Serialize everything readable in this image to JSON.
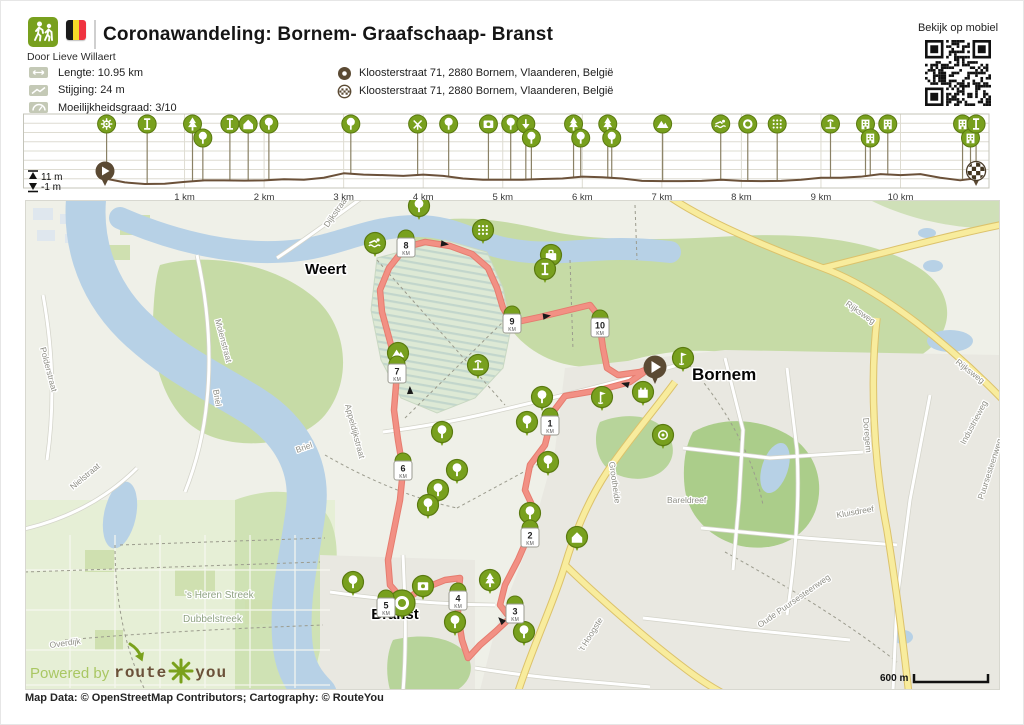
{
  "colors": {
    "marker": "#78a01e",
    "marker_border": "#5a7a10",
    "brown": "#5b4a33",
    "route": "#f29084",
    "route_edge": "#e57c6f",
    "water": "#b7d1e6",
    "grid": "#dedcd2",
    "frame": "#c4c4ba"
  },
  "header": {
    "title": "Coronawandeling: Bornem- Graafschaap- Branst",
    "author": "Door Lieve Willaert"
  },
  "qr": {
    "label": "Bekijk op mobiel"
  },
  "stats": {
    "items": [
      {
        "icon": "distance-icon",
        "text": "Lengte: 10.95 km"
      },
      {
        "icon": "ascent-icon",
        "text": "Stijging: 24 m"
      },
      {
        "icon": "difficulty-icon",
        "text": "Moeilijkheidsgraad: 3/10"
      }
    ]
  },
  "addresses": {
    "items": [
      {
        "icon": "start-marker-icon",
        "text": "Kloosterstraat 71, 2880 Bornem, Vlaanderen, België"
      },
      {
        "icon": "finish-marker-icon",
        "text": "Kloosterstraat 71, 2880 Bornem, Vlaanderen, België"
      }
    ]
  },
  "chart_data": {
    "type": "line",
    "title": "Elevation profile",
    "xlabel": "distance",
    "ylabel": "elevation",
    "x_unit": "km",
    "xlim": [
      0,
      10.95
    ],
    "ylim": [
      -1,
      11
    ],
    "max_label": "11 m",
    "min_label": "-1 m",
    "x_ticks": [
      "1 km",
      "2 km",
      "3 km",
      "4 km",
      "5 km",
      "6 km",
      "7 km",
      "8 km",
      "9 km",
      "10 km"
    ],
    "x_km": [
      0,
      0.25,
      0.5,
      0.75,
      1,
      1.25,
      1.5,
      1.75,
      2,
      2.25,
      2.5,
      2.75,
      3,
      3.25,
      3.5,
      3.75,
      4,
      4.25,
      4.5,
      4.75,
      5,
      5.25,
      5.5,
      5.75,
      6,
      6.25,
      6.5,
      6.75,
      7,
      7.25,
      7.5,
      7.75,
      8,
      8.25,
      8.5,
      8.75,
      9,
      9.25,
      9.5,
      9.75,
      10,
      10.25,
      10.5,
      10.75,
      10.95
    ],
    "elevation_m": [
      2.5,
      1,
      0.4,
      0.5,
      1.2,
      1.8,
      1.8,
      1.7,
      1.8,
      2.2,
      2,
      2.8,
      4.5,
      4,
      3.8,
      3.5,
      4,
      3.5,
      2.5,
      2,
      2,
      2,
      2.3,
      2.5,
      3.2,
      3,
      2.5,
      1.6,
      1.5,
      1.5,
      1.6,
      2,
      1.6,
      1.5,
      1.6,
      2,
      2.8,
      2.8,
      3.2,
      4.2,
      3.8,
      4.2,
      2.8,
      1.8,
      2.6
    ],
    "markers": [
      {
        "km": 0.02,
        "icon": "gear",
        "row": 0
      },
      {
        "km": 0.53,
        "icon": "tower",
        "row": 0
      },
      {
        "km": 1.1,
        "icon": "conifer",
        "row": 0
      },
      {
        "km": 1.23,
        "icon": "tree",
        "row": 1
      },
      {
        "km": 1.57,
        "icon": "tower",
        "row": 0
      },
      {
        "km": 1.8,
        "icon": "house",
        "row": 0
      },
      {
        "km": 2.06,
        "icon": "tree",
        "row": 0
      },
      {
        "km": 3.09,
        "icon": "tree",
        "row": 0
      },
      {
        "km": 3.93,
        "icon": "windmill",
        "row": 0
      },
      {
        "km": 4.32,
        "icon": "tree",
        "row": 0
      },
      {
        "km": 4.82,
        "icon": "photo",
        "row": 0
      },
      {
        "km": 5.1,
        "icon": "tree",
        "row": 0
      },
      {
        "km": 5.29,
        "icon": "arrowdown",
        "row": 0
      },
      {
        "km": 5.36,
        "icon": "tree",
        "row": 1
      },
      {
        "km": 5.89,
        "icon": "conifer",
        "row": 0
      },
      {
        "km": 5.98,
        "icon": "tree",
        "row": 1
      },
      {
        "km": 6.32,
        "icon": "conifer",
        "row": 0
      },
      {
        "km": 6.37,
        "icon": "tree",
        "row": 1
      },
      {
        "km": 7.01,
        "icon": "mountain",
        "row": 0
      },
      {
        "km": 7.74,
        "icon": "swim",
        "row": 0
      },
      {
        "km": 8.08,
        "icon": "ring",
        "row": 0
      },
      {
        "km": 8.45,
        "icon": "grid",
        "row": 0
      },
      {
        "km": 9.12,
        "icon": "fountain",
        "row": 0
      },
      {
        "km": 9.56,
        "icon": "building",
        "row": 0
      },
      {
        "km": 9.62,
        "icon": "building",
        "row": 1
      },
      {
        "km": 9.84,
        "icon": "building",
        "row": 0
      },
      {
        "km": 10.78,
        "icon": "building",
        "row": 0
      },
      {
        "km": 10.88,
        "icon": "building",
        "row": 1
      },
      {
        "km": 10.95,
        "icon": "tower",
        "row": 0
      }
    ]
  },
  "map": {
    "city_labels": [
      {
        "text": "Weert",
        "x": 280,
        "y": 74,
        "size": 15,
        "anchor": "start"
      },
      {
        "text": "Bornem",
        "x": 667,
        "y": 180,
        "size": 17,
        "anchor": "start"
      },
      {
        "text": "Branst",
        "x": 370,
        "y": 419,
        "size": 15,
        "anchor": "middle"
      }
    ],
    "street_labels": [
      {
        "text": "Dijkstraat",
        "x": 303,
        "y": 28,
        "rot": -55
      },
      {
        "text": "Molenstraat",
        "x": 190,
        "y": 120,
        "rot": 75
      },
      {
        "text": "Briel",
        "x": 188,
        "y": 190,
        "rot": 80
      },
      {
        "text": "Briel",
        "x": 272,
        "y": 253,
        "rot": -20
      },
      {
        "text": "Appeldijkstraat",
        "x": 320,
        "y": 205,
        "rot": 75
      },
      {
        "text": "Polderstraat",
        "x": 15,
        "y": 148,
        "rot": 75
      },
      {
        "text": "Nielstraat",
        "x": 48,
        "y": 290,
        "rot": -40
      },
      {
        "text": "Overdijk",
        "x": 25,
        "y": 448,
        "rot": -8
      },
      {
        "text": "'s Heren Streek",
        "x": 160,
        "y": 398,
        "rot": 0,
        "color": "#90a383",
        "size": 10
      },
      {
        "text": "Dubbelstreek",
        "x": 158,
        "y": 422,
        "rot": 0,
        "color": "#90a383",
        "size": 10
      },
      {
        "text": "Rijksweg",
        "x": 820,
        "y": 105,
        "rot": 35
      },
      {
        "text": "Rijksweg",
        "x": 930,
        "y": 163,
        "rot": 38
      },
      {
        "text": "Industrieweg",
        "x": 940,
        "y": 245,
        "rot": -62
      },
      {
        "text": "Doregem",
        "x": 838,
        "y": 218,
        "rot": 85
      },
      {
        "text": "Puursesteenweg",
        "x": 958,
        "y": 300,
        "rot": -72
      },
      {
        "text": "Grootheide",
        "x": 584,
        "y": 262,
        "rot": 82
      },
      {
        "text": "Bareldreef",
        "x": 642,
        "y": 303,
        "rot": 0
      },
      {
        "text": "'t Hoogste",
        "x": 558,
        "y": 452,
        "rot": -58
      },
      {
        "text": "Kluisdreef",
        "x": 812,
        "y": 318,
        "rot": -10
      },
      {
        "text": "Oude Puursesteenweg",
        "x": 735,
        "y": 428,
        "rot": -35
      }
    ],
    "km_markers": [
      {
        "n": "1",
        "sub": "KM",
        "x": 525,
        "y": 225
      },
      {
        "n": "2",
        "sub": "KM",
        "x": 505,
        "y": 337
      },
      {
        "n": "3",
        "sub": "KM",
        "x": 490,
        "y": 413
      },
      {
        "n": "4",
        "sub": "KM",
        "x": 433,
        "y": 400
      },
      {
        "n": "5",
        "sub": "KM",
        "x": 361,
        "y": 407
      },
      {
        "n": "6",
        "sub": "KM",
        "x": 378,
        "y": 270
      },
      {
        "n": "7",
        "sub": "KM",
        "x": 372,
        "y": 173
      },
      {
        "n": "8",
        "sub": "KM",
        "x": 381,
        "y": 47
      },
      {
        "n": "9",
        "sub": "KM",
        "x": 487,
        "y": 123
      },
      {
        "n": "10",
        "sub": "KM",
        "x": 575,
        "y": 127
      }
    ],
    "poi_markers": [
      {
        "x": 350,
        "y": 43,
        "icon": "swim"
      },
      {
        "x": 394,
        "y": 6,
        "icon": "tree"
      },
      {
        "x": 458,
        "y": 30,
        "icon": "grid"
      },
      {
        "x": 526,
        "y": 55,
        "icon": "suitcase"
      },
      {
        "x": 520,
        "y": 69,
        "icon": "tower"
      },
      {
        "x": 373,
        "y": 153,
        "icon": "mountain"
      },
      {
        "x": 453,
        "y": 165,
        "icon": "fountain"
      },
      {
        "x": 658,
        "y": 158,
        "icon": "golf"
      },
      {
        "x": 618,
        "y": 192,
        "icon": "castle"
      },
      {
        "x": 577,
        "y": 197,
        "icon": "golf"
      },
      {
        "x": 638,
        "y": 235,
        "icon": "target"
      },
      {
        "x": 517,
        "y": 197,
        "icon": "tree"
      },
      {
        "x": 502,
        "y": 222,
        "icon": "tree"
      },
      {
        "x": 417,
        "y": 232,
        "icon": "tree"
      },
      {
        "x": 432,
        "y": 270,
        "icon": "tree"
      },
      {
        "x": 523,
        "y": 262,
        "icon": "tree"
      },
      {
        "x": 413,
        "y": 290,
        "icon": "tree"
      },
      {
        "x": 403,
        "y": 305,
        "icon": "tree"
      },
      {
        "x": 505,
        "y": 313,
        "icon": "tree"
      },
      {
        "x": 552,
        "y": 337,
        "icon": "house"
      },
      {
        "x": 328,
        "y": 382,
        "icon": "tree"
      },
      {
        "x": 398,
        "y": 386,
        "icon": "photo"
      },
      {
        "x": 377,
        "y": 403,
        "icon": "roundabout",
        "big": true
      },
      {
        "x": 430,
        "y": 422,
        "icon": "tree"
      },
      {
        "x": 465,
        "y": 380,
        "icon": "conifer"
      },
      {
        "x": 499,
        "y": 432,
        "icon": "tree"
      }
    ],
    "route": [
      [
        625,
        168
      ],
      [
        605,
        182
      ],
      [
        575,
        190
      ],
      [
        540,
        196
      ],
      [
        528,
        212
      ],
      [
        525,
        225
      ],
      [
        520,
        245
      ],
      [
        505,
        265
      ],
      [
        500,
        290
      ],
      [
        507,
        305
      ],
      [
        503,
        337
      ],
      [
        493,
        360
      ],
      [
        480,
        385
      ],
      [
        475,
        405
      ],
      [
        485,
        418
      ],
      [
        470,
        432
      ],
      [
        455,
        445
      ],
      [
        443,
        458
      ],
      [
        437,
        440
      ],
      [
        433,
        415
      ],
      [
        433,
        400
      ],
      [
        435,
        378
      ],
      [
        420,
        380
      ],
      [
        395,
        390
      ],
      [
        379,
        401
      ],
      [
        365,
        385
      ],
      [
        363,
        360
      ],
      [
        369,
        330
      ],
      [
        375,
        300
      ],
      [
        378,
        270
      ],
      [
        373,
        240
      ],
      [
        369,
        210
      ],
      [
        372,
        173
      ],
      [
        366,
        145
      ],
      [
        357,
        112
      ],
      [
        355,
        90
      ],
      [
        364,
        68
      ],
      [
        375,
        54
      ],
      [
        381,
        47
      ],
      [
        400,
        42
      ],
      [
        425,
        46
      ],
      [
        447,
        54
      ],
      [
        463,
        68
      ],
      [
        472,
        88
      ],
      [
        478,
        108
      ],
      [
        487,
        123
      ],
      [
        515,
        117
      ],
      [
        540,
        111
      ],
      [
        565,
        105
      ],
      [
        572,
        114
      ],
      [
        575,
        127
      ],
      [
        578,
        148
      ],
      [
        582,
        168
      ],
      [
        593,
        175
      ],
      [
        615,
        172
      ],
      [
        625,
        168
      ]
    ],
    "arrows": [
      {
        "x": 600,
        "y": 184,
        "angle": 195
      },
      {
        "x": 385,
        "y": 190,
        "angle": 268
      },
      {
        "x": 420,
        "y": 44,
        "angle": 8
      },
      {
        "x": 522,
        "y": 116,
        "angle": 352
      },
      {
        "x": 476,
        "y": 420,
        "angle": 225
      }
    ],
    "start_pin": {
      "x": 630,
      "y": 167
    },
    "scale": {
      "label": "600 m"
    },
    "powered": {
      "prefix": "Powered by",
      "brand_left": "route",
      "brand_right": "you"
    }
  },
  "footer": {
    "attribution": "Map Data: © OpenStreetMap Contributors; Cartography: © RouteYou"
  }
}
